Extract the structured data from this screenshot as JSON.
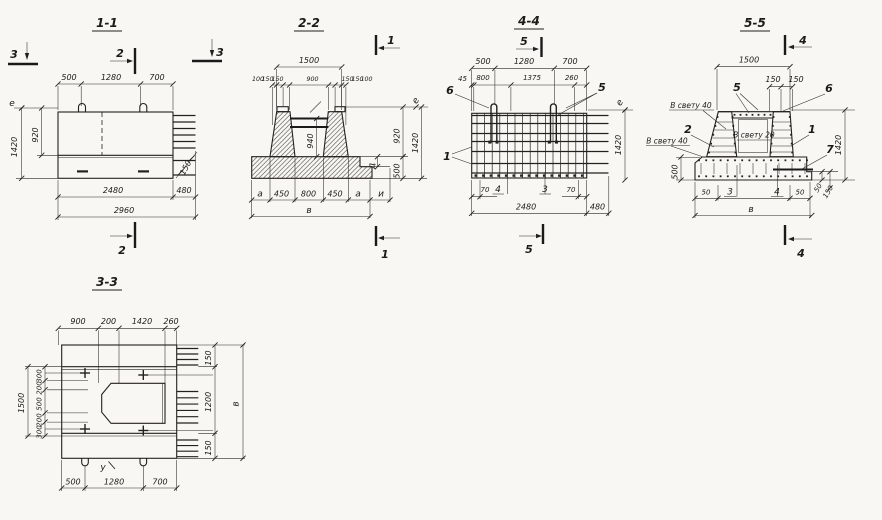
{
  "views": {
    "s11": {
      "title": "1-1",
      "m2": "2",
      "m3": "3",
      "d500": "500",
      "d1280": "1280",
      "d700": "700",
      "e": "е",
      "d1420": "1420",
      "d920": "920",
      "d150": "150",
      "d2480": "2480",
      "d480": "480",
      "d2960": "2960"
    },
    "s22": {
      "title": "2-2",
      "m1": "1",
      "d1500": "1500",
      "d100": "100",
      "d150": "150",
      "d900": "900",
      "d940": "940",
      "e": "е",
      "d920": "920",
      "d1420": "1420",
      "d500": "500",
      "dd": "д",
      "da": "а",
      "d450": "450",
      "d800": "800",
      "di": "и",
      "dv": "в"
    },
    "s44": {
      "title": "4-4",
      "m5": "5",
      "d500": "500",
      "d1280": "1280",
      "d700": "700",
      "d45": "45",
      "d800": "800",
      "d1375": "1375",
      "d260": "260",
      "p6": "6",
      "p5": "5",
      "e": "е",
      "p1": "1",
      "d1420": "1420",
      "d70": "70",
      "p4": "4",
      "p3": "3",
      "d2480": "2480",
      "d480": "480"
    },
    "s55": {
      "title": "5-5",
      "m4": "4",
      "d1500": "1500",
      "d150": "150",
      "p5": "5",
      "p6": "6",
      "clear40": "В свету 40",
      "p2": "2",
      "clear20": "В свету 20",
      "p1": "1",
      "p7": "7",
      "d500": "500",
      "d1420": "1420",
      "d50": "50",
      "p3": "3",
      "p4": "4",
      "dv": "в"
    },
    "s33": {
      "title": "3-3",
      "d900": "900",
      "d200": "200",
      "d1420": "1420",
      "d260": "260",
      "d1500": "1500",
      "d300": "300",
      "d500": "500",
      "d150": "150",
      "d1200": "1200",
      "dv": "в",
      "pu": "у",
      "d1280": "1280",
      "d700": "700"
    }
  }
}
